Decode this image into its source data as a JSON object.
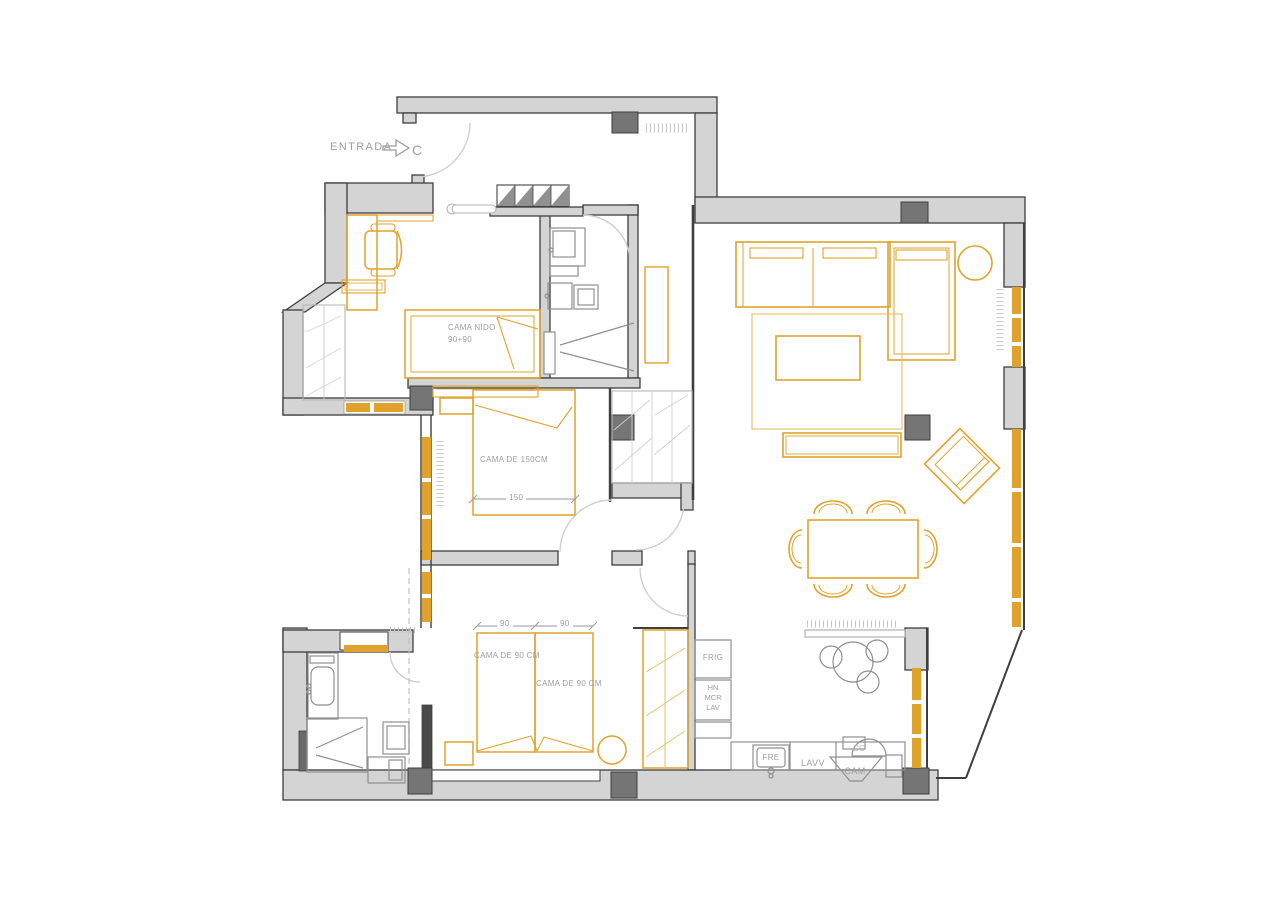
{
  "title": "apartment-floor-plan",
  "colors": {
    "wall_fill": "#d4d4d4",
    "wall_stroke": "#3e3e3e",
    "column_fill": "#757575",
    "furniture_accent": "#dfa32b",
    "furniture_accent_light": "#e6c06b",
    "fixture_gray": "#8f8f8f",
    "door_swing_gray": "#cfcfcf",
    "label_gray": "#9e9e9e",
    "background": "#ffffff"
  },
  "labels": {
    "entrada": "ENTRADA",
    "door_c": "C",
    "cama_nido_1": "CAMA NIDO",
    "cama_nido_2": "90+90",
    "cama_150": "CAMA DE 150CM",
    "dim_150": "150",
    "dim_90_a": "90",
    "dim_90_b": "90",
    "cama_90_a": "CAMA DE 90 CM",
    "cama_90_b": "CAMA DE 90 CM",
    "frig": "FRIG",
    "hn": "HN",
    "mcr": "MCR",
    "lav": "LAV",
    "fre": "FRE",
    "lavv": "LAVV",
    "cam": "CAM",
    "cc": "CC"
  }
}
